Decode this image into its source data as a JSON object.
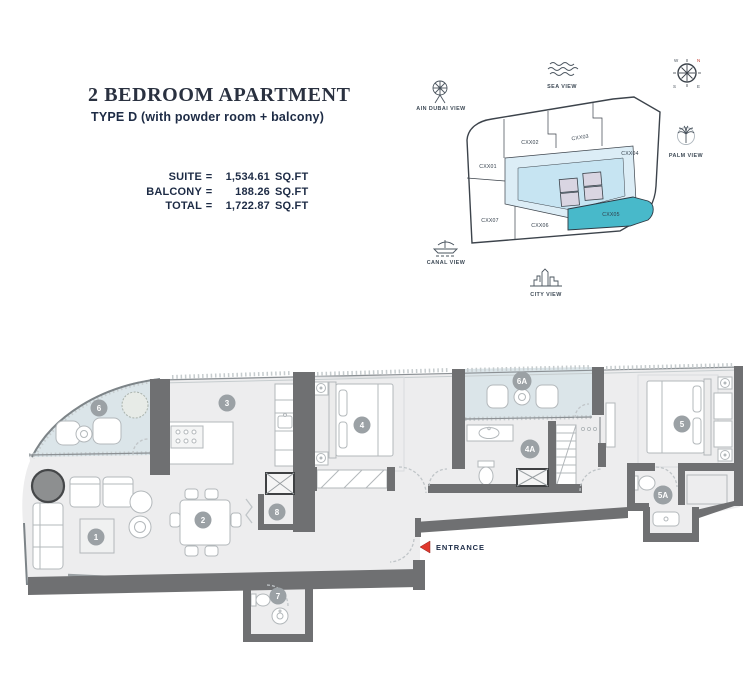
{
  "header": {
    "title": "2 BEDROOM APARTMENT",
    "subtitle": "TYPE D (with powder room + balcony)",
    "areas": [
      {
        "label": "SUITE",
        "eq": "=",
        "value": "1,534.61",
        "unit": "SQ.FT"
      },
      {
        "label": "BALCONY",
        "eq": "=",
        "value": "188.26",
        "unit": "SQ.FT"
      },
      {
        "label": "TOTAL",
        "eq": "=",
        "value": "1,722.87",
        "unit": "SQ.FT"
      }
    ]
  },
  "keyplan": {
    "views": [
      {
        "id": "ain-dubai",
        "label": "AIN DUBAI VIEW"
      },
      {
        "id": "sea",
        "label": "SEA VIEW"
      },
      {
        "id": "palm",
        "label": "PALM VIEW"
      },
      {
        "id": "canal",
        "label": "CANAL VIEW"
      },
      {
        "id": "city",
        "label": "CITY VIEW"
      }
    ],
    "units": [
      {
        "id": "CXX01",
        "highlighted": false
      },
      {
        "id": "CXX02",
        "highlighted": false
      },
      {
        "id": "CXX03",
        "highlighted": false
      },
      {
        "id": "CXX04",
        "highlighted": false
      },
      {
        "id": "CXX05",
        "highlighted": true
      },
      {
        "id": "CXX06",
        "highlighted": false
      },
      {
        "id": "CXX07",
        "highlighted": false
      }
    ],
    "colors": {
      "highlight": "#48b9ca",
      "lobby": "#dcedf6",
      "corridor": "#c6e4f2",
      "shaft": "#d9d5e2"
    }
  },
  "floorplan": {
    "rooms": [
      {
        "marker": "1"
      },
      {
        "marker": "2"
      },
      {
        "marker": "3"
      },
      {
        "marker": "4"
      },
      {
        "marker": "5"
      },
      {
        "marker": "6"
      },
      {
        "marker": "7"
      },
      {
        "marker": "8"
      },
      {
        "marker": "4A"
      },
      {
        "marker": "5A"
      },
      {
        "marker": "6A"
      }
    ],
    "entrance": {
      "label": "ENTRANCE"
    },
    "colors": {
      "wall": "#6f7072",
      "floor": "#ededee",
      "balcony": "#dbe5e9",
      "marker": "#9ba1a5",
      "arrow": "#e0392e",
      "text": "#1d2c47"
    }
  }
}
